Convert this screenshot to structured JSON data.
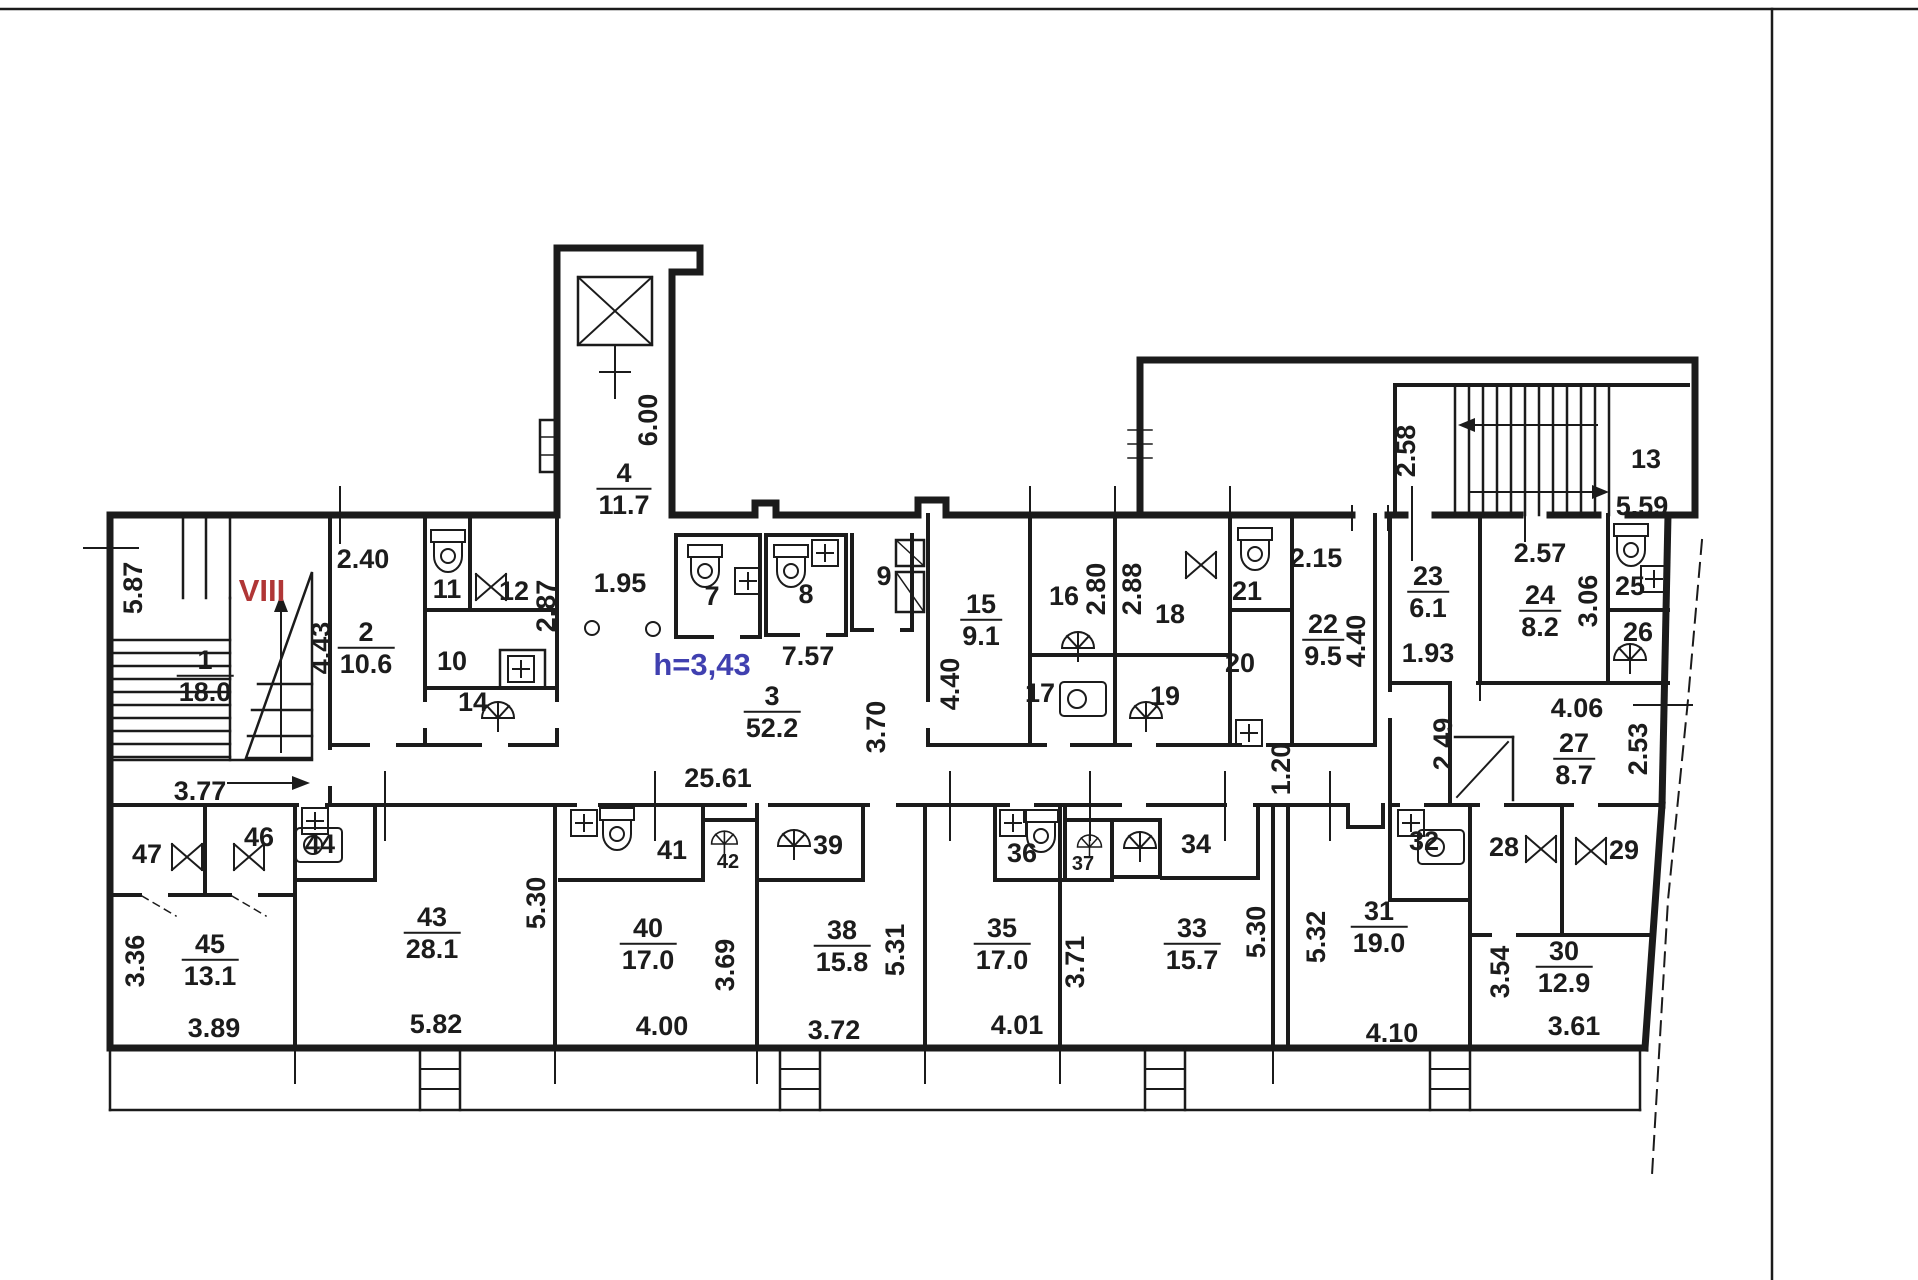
{
  "page": {
    "background": "#ffffff",
    "ink": "#1b1b1b"
  },
  "drawing": {
    "type": "apartment-floor-plan",
    "section_note": "VIII",
    "height_note": "h=3,43",
    "colors": {
      "section_note": "#b03636",
      "height_note": "#4040b0",
      "ink": "#1b1b1b"
    }
  },
  "rooms": [
    {
      "num": "1",
      "area": "18.0",
      "x": 205,
      "y": 676
    },
    {
      "num": "2",
      "area": "10.6",
      "x": 366,
      "y": 648
    },
    {
      "num": "3",
      "area": "52.2",
      "x": 772,
      "y": 712
    },
    {
      "num": "4",
      "area": "11.7",
      "x": 624,
      "y": 489
    },
    {
      "num": "7",
      "x": 712,
      "y": 597
    },
    {
      "num": "8",
      "x": 806,
      "y": 595
    },
    {
      "num": "9",
      "x": 884,
      "y": 577
    },
    {
      "num": "10",
      "x": 452,
      "y": 662
    },
    {
      "num": "11",
      "x": 447,
      "y": 590
    },
    {
      "num": "12",
      "x": 514,
      "y": 592
    },
    {
      "num": "13",
      "x": 1646,
      "y": 460
    },
    {
      "num": "14",
      "x": 473,
      "y": 703
    },
    {
      "num": "15",
      "area": "9.1",
      "x": 981,
      "y": 620
    },
    {
      "num": "16",
      "x": 1064,
      "y": 597
    },
    {
      "num": "17",
      "x": 1040,
      "y": 694
    },
    {
      "num": "18",
      "x": 1170,
      "y": 615
    },
    {
      "num": "19",
      "x": 1165,
      "y": 697
    },
    {
      "num": "20",
      "x": 1240,
      "y": 664
    },
    {
      "num": "21",
      "x": 1247,
      "y": 592
    },
    {
      "num": "22",
      "area": "9.5",
      "x": 1323,
      "y": 640
    },
    {
      "num": "23",
      "area": "6.1",
      "x": 1428,
      "y": 592
    },
    {
      "num": "24",
      "area": "8.2",
      "x": 1540,
      "y": 611
    },
    {
      "num": "25",
      "x": 1630,
      "y": 587
    },
    {
      "num": "26",
      "x": 1638,
      "y": 633
    },
    {
      "num": "27",
      "area": "8.7",
      "x": 1574,
      "y": 759
    },
    {
      "num": "28",
      "x": 1504,
      "y": 848
    },
    {
      "num": "29",
      "x": 1624,
      "y": 851
    },
    {
      "num": "30",
      "area": "12.9",
      "x": 1564,
      "y": 967
    },
    {
      "num": "31",
      "area": "19.0",
      "x": 1379,
      "y": 927
    },
    {
      "num": "32",
      "x": 1424,
      "y": 842
    },
    {
      "num": "33",
      "area": "15.7",
      "x": 1192,
      "y": 944
    },
    {
      "num": "34",
      "x": 1196,
      "y": 845
    },
    {
      "num": "35",
      "area": "17.0",
      "x": 1002,
      "y": 944
    },
    {
      "num": "36",
      "x": 1022,
      "y": 854
    },
    {
      "num": "37",
      "x": 1083,
      "y": 864,
      "small": true
    },
    {
      "num": "38",
      "area": "15.8",
      "x": 842,
      "y": 946
    },
    {
      "num": "39",
      "x": 828,
      "y": 846
    },
    {
      "num": "40",
      "area": "17.0",
      "x": 648,
      "y": 944
    },
    {
      "num": "41",
      "x": 672,
      "y": 851
    },
    {
      "num": "42",
      "x": 728,
      "y": 862,
      "small": true
    },
    {
      "num": "43",
      "area": "28.1",
      "x": 432,
      "y": 933
    },
    {
      "num": "44",
      "x": 320,
      "y": 845
    },
    {
      "num": "45",
      "area": "13.1",
      "x": 210,
      "y": 960
    },
    {
      "num": "46",
      "x": 259,
      "y": 838
    },
    {
      "num": "47",
      "x": 147,
      "y": 855
    }
  ],
  "dimensions": [
    {
      "t": "5.87",
      "x": 134,
      "y": 588,
      "r": -90
    },
    {
      "t": "2.40",
      "x": 363,
      "y": 560
    },
    {
      "t": "4.43",
      "x": 322,
      "y": 648,
      "r": -90
    },
    {
      "t": "3.77",
      "x": 200,
      "y": 792
    },
    {
      "t": "6.00",
      "x": 649,
      "y": 420,
      "r": -90
    },
    {
      "t": "1.95",
      "x": 620,
      "y": 584
    },
    {
      "t": "2.87",
      "x": 547,
      "y": 606,
      "r": -90
    },
    {
      "t": "7.57",
      "x": 808,
      "y": 657
    },
    {
      "t": "25.61",
      "x": 718,
      "y": 779
    },
    {
      "t": "3.70",
      "x": 877,
      "y": 727,
      "r": -90
    },
    {
      "t": "4.40",
      "x": 951,
      "y": 684,
      "r": -90
    },
    {
      "t": "2.80",
      "x": 1097,
      "y": 589,
      "r": -90
    },
    {
      "t": "2.88",
      "x": 1133,
      "y": 589,
      "r": -90
    },
    {
      "t": "2.15",
      "x": 1316,
      "y": 559
    },
    {
      "t": "4.40",
      "x": 1357,
      "y": 641,
      "r": -90
    },
    {
      "t": "1.20",
      "x": 1282,
      "y": 769,
      "r": -90
    },
    {
      "t": "2.58",
      "x": 1407,
      "y": 451,
      "r": -90
    },
    {
      "t": "5.59",
      "x": 1642,
      "y": 507
    },
    {
      "t": "2.57",
      "x": 1540,
      "y": 554
    },
    {
      "t": "3.06",
      "x": 1589,
      "y": 601,
      "r": -90
    },
    {
      "t": "1.93",
      "x": 1428,
      "y": 654
    },
    {
      "t": "2.49",
      "x": 1444,
      "y": 744,
      "r": -90
    },
    {
      "t": "4.06",
      "x": 1577,
      "y": 709
    },
    {
      "t": "2.53",
      "x": 1639,
      "y": 749,
      "r": -90
    },
    {
      "t": "3.36",
      "x": 136,
      "y": 961,
      "r": -90
    },
    {
      "t": "3.89",
      "x": 214,
      "y": 1029
    },
    {
      "t": "5.30",
      "x": 537,
      "y": 903,
      "r": -90
    },
    {
      "t": "5.82",
      "x": 436,
      "y": 1025
    },
    {
      "t": "3.69",
      "x": 726,
      "y": 965,
      "r": -90
    },
    {
      "t": "4.00",
      "x": 662,
      "y": 1027
    },
    {
      "t": "5.31",
      "x": 896,
      "y": 950,
      "r": -90
    },
    {
      "t": "3.72",
      "x": 834,
      "y": 1031
    },
    {
      "t": "3.71",
      "x": 1076,
      "y": 962,
      "r": -90
    },
    {
      "t": "4.01",
      "x": 1017,
      "y": 1026
    },
    {
      "t": "5.30",
      "x": 1257,
      "y": 932,
      "r": -90
    },
    {
      "t": "5.32",
      "x": 1317,
      "y": 937,
      "r": -90
    },
    {
      "t": "4.10",
      "x": 1392,
      "y": 1034
    },
    {
      "t": "3.54",
      "x": 1501,
      "y": 972,
      "r": -90
    },
    {
      "t": "3.61",
      "x": 1574,
      "y": 1027
    }
  ],
  "notes": [
    {
      "t": "VIII",
      "x": 262,
      "y": 591,
      "color": "section_note",
      "name": "section-note"
    },
    {
      "t": "h=3,43",
      "x": 702,
      "y": 665,
      "color": "height_note",
      "name": "height-note"
    }
  ]
}
